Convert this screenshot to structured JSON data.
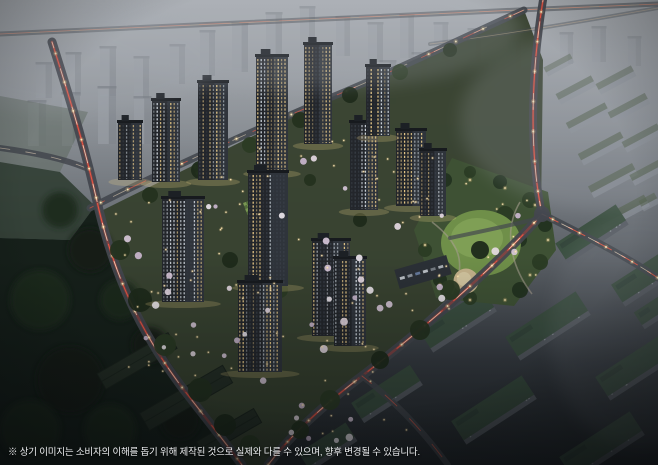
{
  "meta": {
    "width": 658,
    "height": 465,
    "scene_type": "apartment-complex-aerial-night-rendering"
  },
  "caption": {
    "text": "※ 상기 이미지는 소비자의 이해를 돕기 위해 제작된 것으로 실제와 다를 수 있으며, 향후 변경될 수 있습니다."
  },
  "palette": {
    "sky_top": "#a9adb2",
    "sky_mid": "#868b91",
    "dusk": "#5c6167",
    "ground_dark": "#22262a",
    "complex_ground": "#37422f",
    "forest": "#16201a",
    "tower_body": "#23262b",
    "tower_face": "#2f343b",
    "window_warm": "#f5d48e",
    "window_cool": "#dfe7ee",
    "road": "#43474e",
    "trail_red": "#ff5a44",
    "trail_white": "#ffe7c9",
    "park_lawn": "#6f8f49",
    "park_lawn_light": "#81a156",
    "sand": "#c4b28b",
    "tree_dark": "#24321f",
    "blossom": "#e8dce6",
    "light_warm": "#ffd98c",
    "slab_gray": "#9ba0a7",
    "slab_roof_green": "#3a4f3f",
    "haze": "#a6abb3"
  },
  "scene": {
    "bg_stops": [
      [
        0,
        "#a9adb2"
      ],
      [
        0.3,
        "#868b91"
      ],
      [
        0.55,
        "#5c6167"
      ],
      [
        0.78,
        "#363b41"
      ],
      [
        1,
        "#22262a"
      ]
    ],
    "distant_buildings": [
      [
        36,
        62,
        16,
        36,
        0.4
      ],
      [
        66,
        52,
        15,
        44,
        0.45
      ],
      [
        100,
        46,
        16,
        50,
        0.5
      ],
      [
        134,
        56,
        15,
        42,
        0.48
      ],
      [
        28,
        100,
        18,
        46,
        0.55
      ],
      [
        62,
        92,
        18,
        54,
        0.58
      ],
      [
        98,
        86,
        18,
        58,
        0.6
      ],
      [
        134,
        96,
        17,
        48,
        0.55
      ],
      [
        170,
        44,
        15,
        40,
        0.42
      ],
      [
        200,
        30,
        15,
        46,
        0.4
      ],
      [
        232,
        22,
        16,
        50,
        0.42
      ],
      [
        266,
        12,
        16,
        48,
        0.4
      ],
      [
        300,
        6,
        15,
        44,
        0.38
      ],
      [
        336,
        16,
        14,
        40,
        0.36
      ],
      [
        368,
        22,
        15,
        40,
        0.38
      ],
      [
        400,
        14,
        14,
        44,
        0.36
      ],
      [
        434,
        22,
        14,
        38,
        0.34
      ],
      [
        468,
        28,
        13,
        34,
        0.33
      ],
      [
        508,
        40,
        13,
        30,
        0.3
      ],
      [
        560,
        32,
        13,
        32,
        0.3
      ],
      [
        592,
        26,
        14,
        36,
        0.3
      ],
      [
        628,
        36,
        13,
        30,
        0.28
      ],
      [
        380,
        60,
        16,
        44,
        0.42
      ],
      [
        412,
        52,
        15,
        46,
        0.4
      ],
      [
        446,
        60,
        14,
        40,
        0.38
      ]
    ],
    "hazy_slabs": [
      [
        544,
        60,
        30,
        10,
        0.45
      ],
      [
        556,
        84,
        40,
        12,
        0.5
      ],
      [
        596,
        74,
        40,
        12,
        0.48
      ],
      [
        566,
        112,
        44,
        12,
        0.55
      ],
      [
        608,
        102,
        42,
        12,
        0.52
      ],
      [
        578,
        142,
        48,
        13,
        0.58
      ],
      [
        622,
        132,
        40,
        12,
        0.55
      ],
      [
        588,
        174,
        50,
        13,
        0.6
      ],
      [
        630,
        166,
        36,
        12,
        0.58
      ],
      [
        598,
        206,
        52,
        13,
        0.62
      ],
      [
        640,
        196,
        18,
        12,
        0.55
      ]
    ],
    "farm_patches": [
      {
        "pts": "0,96 88,112 60,172 0,162",
        "f": "#5f6a60",
        "o": 0.55
      },
      {
        "pts": "0,162 60,172 95,206 70,240 0,238",
        "f": "#2c3a2e",
        "o": 0.85
      }
    ],
    "complex_poly": "99,212 332,97 524,10 543,60 541,214 362,376 268,465 242,465 184,390 115,276",
    "forest_poly": "0,238 70,240 95,206 118,268 148,330 190,392 232,458 240,465 0,465",
    "forest_blobs": [
      [
        60,
        210,
        18
      ],
      [
        90,
        250,
        22
      ],
      [
        120,
        300,
        20
      ],
      [
        150,
        345,
        18
      ],
      [
        40,
        300,
        30
      ],
      [
        70,
        380,
        34
      ],
      [
        30,
        430,
        30
      ],
      [
        180,
        420,
        20
      ],
      [
        110,
        430,
        26
      ]
    ],
    "warehouses": [
      [
        96,
        352,
        82,
        18,
        -30
      ],
      [
        138,
        388,
        96,
        20,
        -30
      ],
      [
        196,
        424,
        66,
        16,
        -30
      ]
    ],
    "br_slabs": [
      [
        470,
        243,
        78,
        26,
        -33,
        1
      ],
      [
        556,
        222,
        72,
        24,
        -33,
        0.95
      ],
      [
        612,
        262,
        76,
        26,
        -33,
        0.9
      ],
      [
        420,
        308,
        76,
        26,
        -33,
        0.95
      ],
      [
        506,
        312,
        84,
        28,
        -33,
        0.9
      ],
      [
        596,
        352,
        84,
        28,
        -33,
        0.85
      ],
      [
        352,
        382,
        70,
        24,
        -33,
        0.9
      ],
      [
        452,
        396,
        84,
        28,
        -33,
        0.85
      ],
      [
        560,
        432,
        84,
        28,
        -33,
        0.8
      ],
      [
        300,
        436,
        56,
        22,
        -33,
        0.85
      ],
      [
        636,
        300,
        40,
        20,
        -33,
        0.8
      ]
    ],
    "park": {
      "poly": "452,158 548,192 556,250 514,306 436,298 414,230",
      "trees": [
        [
          445,
          180,
          7
        ],
        [
          470,
          172,
          6
        ],
        [
          500,
          182,
          7
        ],
        [
          530,
          200,
          8
        ],
        [
          545,
          225,
          7
        ],
        [
          540,
          262,
          8
        ],
        [
          520,
          290,
          8
        ],
        [
          470,
          298,
          7
        ],
        [
          440,
          280,
          7
        ],
        [
          425,
          250,
          7
        ],
        [
          428,
          210,
          6
        ],
        [
          505,
          215,
          9
        ],
        [
          520,
          240,
          7
        ]
      ],
      "lawn": {
        "cx": 481,
        "cy": 243,
        "rx": 40,
        "ry": 33
      },
      "lawn2": {
        "cx": 477,
        "cy": 238,
        "rx": 26,
        "ry": 20
      },
      "sand": {
        "cx": 466,
        "cy": 281,
        "r": 12.5
      },
      "paths": [
        "M 432,222 C 458,242 468,262 452,294",
        "M 520,202 C 502,232 512,268 532,294"
      ],
      "lights": [
        [
          437,
          205
        ],
        [
          425,
          245
        ],
        [
          440,
          285
        ],
        [
          470,
          300
        ],
        [
          505,
          300
        ],
        [
          530,
          275
        ],
        [
          548,
          240
        ],
        [
          535,
          205
        ],
        [
          505,
          188
        ],
        [
          470,
          180
        ]
      ]
    },
    "parking": {
      "x": 396,
      "y": 262,
      "w": 54,
      "h": 20,
      "rot": -16,
      "cars": [
        "#c9ced4",
        "#9aa1a8",
        "#6b82a6",
        "#c9ced4",
        "#7d848b",
        "#b7bdc3"
      ]
    },
    "roads": [
      {
        "d": "M 0,34 C 160,26 420,14 658,4",
        "w": 5,
        "o": 0.5,
        "lit": 0,
        "trails": [
          [
            "#ffd9b0",
            0.8,
            0.45,
            "",
            0
          ],
          [
            "#ff6a55",
            0.7,
            0.35,
            "30 10",
            0
          ]
        ]
      },
      {
        "d": "M 430,44 C 510,34 590,20 658,8",
        "w": 4,
        "o": 0.35,
        "lit": 0,
        "trails": [
          [
            "#ffd9b0",
            0.7,
            0.35,
            "",
            0
          ]
        ]
      },
      {
        "d": "M 0,148 C 30,152 62,158 86,168",
        "w": 6,
        "o": 0.85,
        "lit": 0,
        "trails": [
          [
            "#ffe7c9",
            0.8,
            0.5,
            "10 16",
            0
          ]
        ]
      },
      {
        "d": "M 90,208 C 170,168 250,132 332,97 C 406,66 462,38 524,10",
        "w": 7,
        "o": 0.9,
        "lit": 1,
        "trails": [
          [
            "#ff5a44",
            0.9,
            0.6,
            "20 26",
            4
          ],
          [
            "#ffe7c9",
            0.8,
            0.55,
            "14 30",
            18
          ]
        ]
      },
      {
        "d": "M 543,0 C 531,74 529,152 542,214",
        "w": 8,
        "o": 0.95,
        "lit": 1,
        "trails": [
          [
            "#ff3b2d",
            2.4,
            0.3,
            "",
            0
          ],
          [
            "#ff5a44",
            1,
            0.85,
            "24 14",
            6
          ],
          [
            "#ffe7c9",
            0.9,
            0.75,
            "16 20",
            14
          ]
        ]
      },
      {
        "d": "M 52,42 C 74,112 86,152 99,210 C 115,276 140,332 184,390 C 208,421 228,446 242,465",
        "w": 9,
        "o": 0.95,
        "lit": 1,
        "trails": [
          [
            "#ff3b2d",
            2.6,
            0.3,
            "",
            0
          ],
          [
            "#ff5a44",
            1,
            0.85,
            "26 16",
            0
          ],
          [
            "#ffe7c9",
            0.9,
            0.8,
            "18 22",
            12
          ]
        ]
      },
      {
        "d": "M 542,214 C 498,264 432,322 362,376 C 322,406 290,436 268,465",
        "w": 9,
        "o": 0.95,
        "lit": 1,
        "trails": [
          [
            "#ff3b2d",
            2.6,
            0.3,
            "",
            0
          ],
          [
            "#ff5a44",
            1,
            0.85,
            "22 15",
            9
          ],
          [
            "#ffe7c9",
            0.9,
            0.75,
            "15 21",
            3
          ]
        ]
      },
      {
        "d": "M 542,214 C 582,234 622,254 658,278",
        "w": 7,
        "o": 0.9,
        "lit": 1,
        "trails": [
          [
            "#ff5a44",
            1,
            0.8,
            "18 12",
            0
          ],
          [
            "#ffe7c9",
            0.8,
            0.7,
            "12 18",
            8
          ]
        ]
      },
      {
        "d": "M 362,376 C 396,402 424,432 448,465",
        "w": 6,
        "o": 0.8,
        "lit": 0,
        "trails": [
          [
            "#ff5a44",
            0.9,
            0.6,
            "16 18",
            4
          ]
        ]
      },
      {
        "d": "M 540,218 C 508,226 478,232 450,238",
        "w": 4,
        "o": 0.7,
        "lit": 0,
        "trails": []
      }
    ],
    "intersection": {
      "cx": 542,
      "cy": 214,
      "r": 8
    },
    "courts": [
      [
        193,
        166,
        -20
      ],
      [
        243,
        203,
        -20
      ],
      [
        268,
        262,
        -20
      ]
    ],
    "complex_trees": [
      [
        120,
        250,
        10
      ],
      [
        140,
        300,
        12
      ],
      [
        165,
        345,
        11
      ],
      [
        200,
        390,
        12
      ],
      [
        225,
        425,
        11
      ],
      [
        250,
        445,
        10
      ],
      [
        150,
        195,
        8
      ],
      [
        200,
        170,
        9
      ],
      [
        250,
        145,
        8
      ],
      [
        300,
        120,
        8
      ],
      [
        350,
        95,
        8
      ],
      [
        400,
        72,
        8
      ],
      [
        450,
        50,
        7
      ],
      [
        480,
        250,
        9
      ],
      [
        450,
        290,
        10
      ],
      [
        420,
        330,
        10
      ],
      [
        380,
        360,
        9
      ],
      [
        330,
        400,
        10
      ],
      [
        300,
        430,
        9
      ],
      [
        230,
        260,
        8
      ],
      [
        280,
        290,
        8
      ],
      [
        320,
        250,
        7
      ],
      [
        360,
        220,
        7
      ],
      [
        270,
        210,
        7
      ],
      [
        310,
        180,
        6
      ]
    ],
    "towers": [
      [
        118,
        122,
        24,
        58
      ],
      [
        152,
        100,
        28,
        82
      ],
      [
        198,
        82,
        30,
        98
      ],
      [
        256,
        56,
        32,
        116
      ],
      [
        304,
        44,
        28,
        100
      ],
      [
        350,
        122,
        28,
        88
      ],
      [
        396,
        130,
        30,
        76
      ],
      [
        420,
        150,
        26,
        66
      ],
      [
        162,
        198,
        42,
        104
      ],
      [
        248,
        172,
        40,
        114
      ],
      [
        312,
        240,
        38,
        96
      ],
      [
        238,
        282,
        44,
        90
      ],
      [
        334,
        258,
        32,
        88
      ],
      [
        366,
        66,
        24,
        70
      ]
    ],
    "blossom_regions": [
      [
        115,
        200,
        120,
        170,
        12
      ],
      [
        220,
        150,
        140,
        210,
        14
      ],
      [
        350,
        170,
        90,
        150,
        8
      ],
      [
        250,
        360,
        130,
        90,
        8
      ],
      [
        430,
        190,
        110,
        110,
        5
      ]
    ],
    "dot_regions": [
      [
        115,
        200,
        130,
        180,
        26
      ],
      [
        215,
        140,
        150,
        230,
        30
      ],
      [
        340,
        150,
        110,
        180,
        18
      ],
      [
        300,
        330,
        120,
        110,
        14
      ],
      [
        430,
        180,
        120,
        120,
        10
      ]
    ],
    "haze_back": [
      [
        600,
        120,
        140,
        90,
        0.2
      ],
      [
        300,
        30,
        220,
        60,
        0.22
      ],
      [
        80,
        60,
        140,
        55,
        0.18
      ],
      [
        640,
        330,
        90,
        120,
        0.1
      ]
    ]
  }
}
